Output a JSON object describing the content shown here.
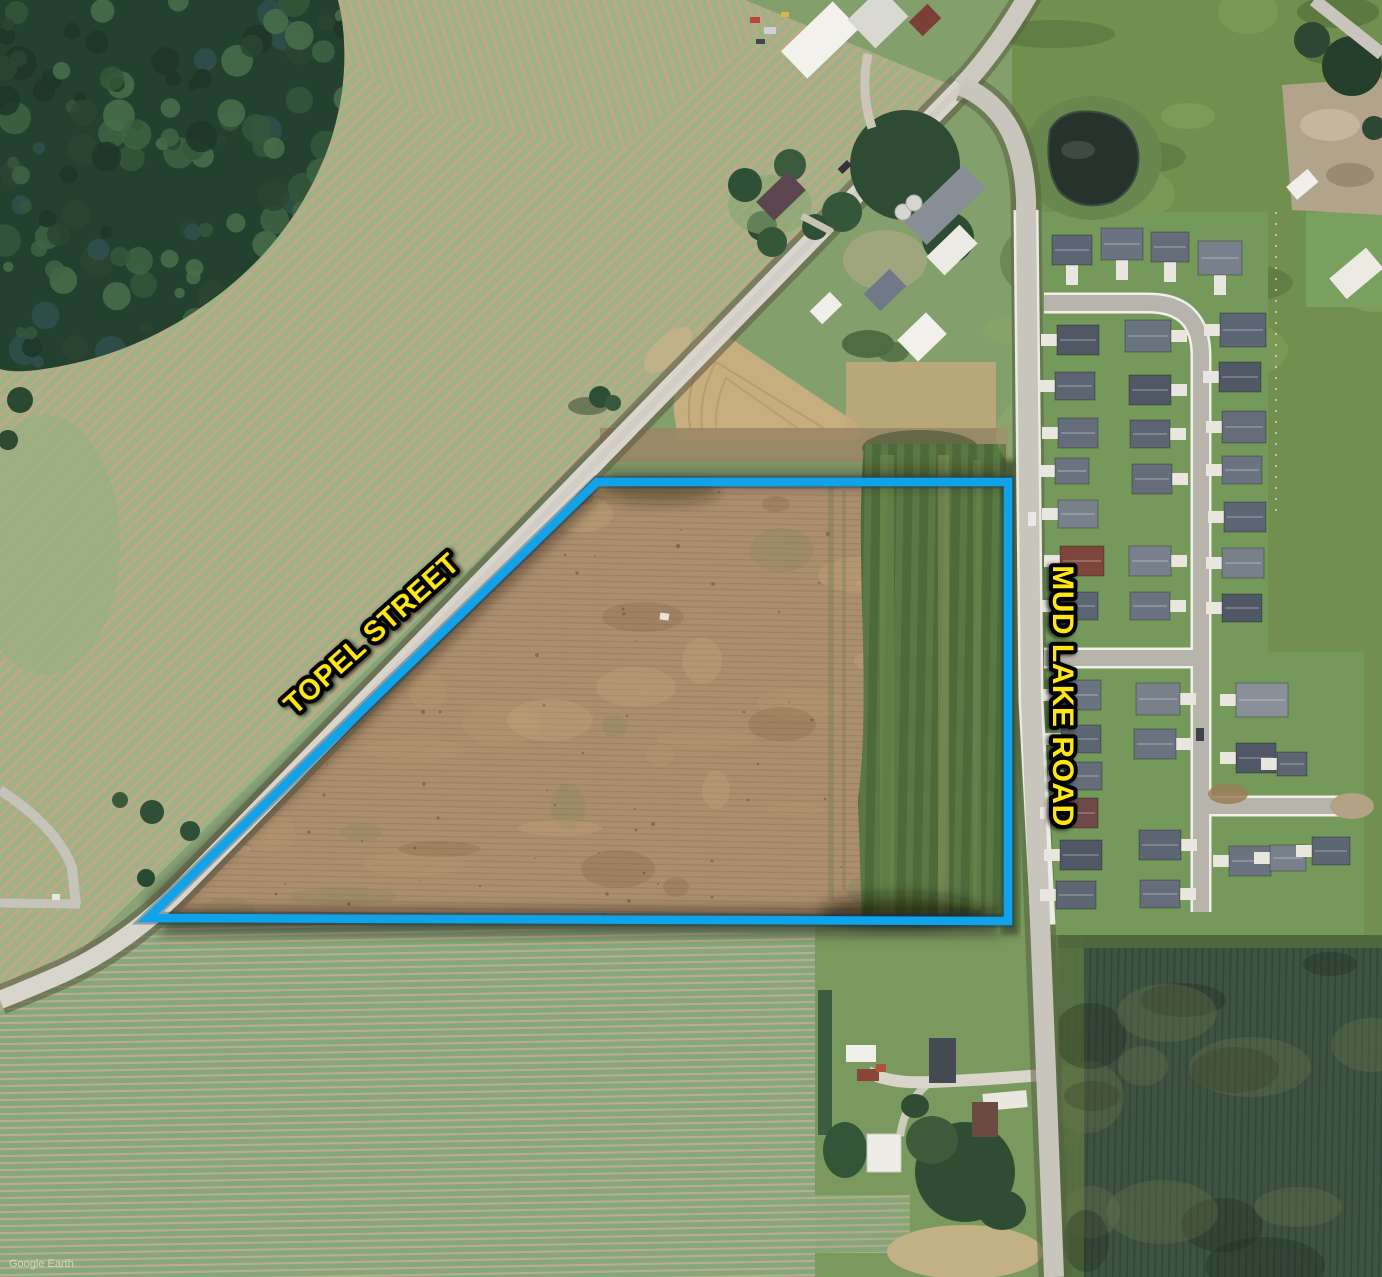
{
  "map": {
    "road_label_topel": "TOPEL STREET",
    "road_label_mud_lake": "MUD LAKE ROAD",
    "watermark": "Google Earth"
  },
  "colors": {
    "boundary_blue": "#10a3ea",
    "label_yellow": "#ffe713",
    "label_outline": "#000000",
    "watermark_white": "#ffffff"
  },
  "parcel": {
    "points": "597,482 1008,482 1008,921 148,918"
  }
}
